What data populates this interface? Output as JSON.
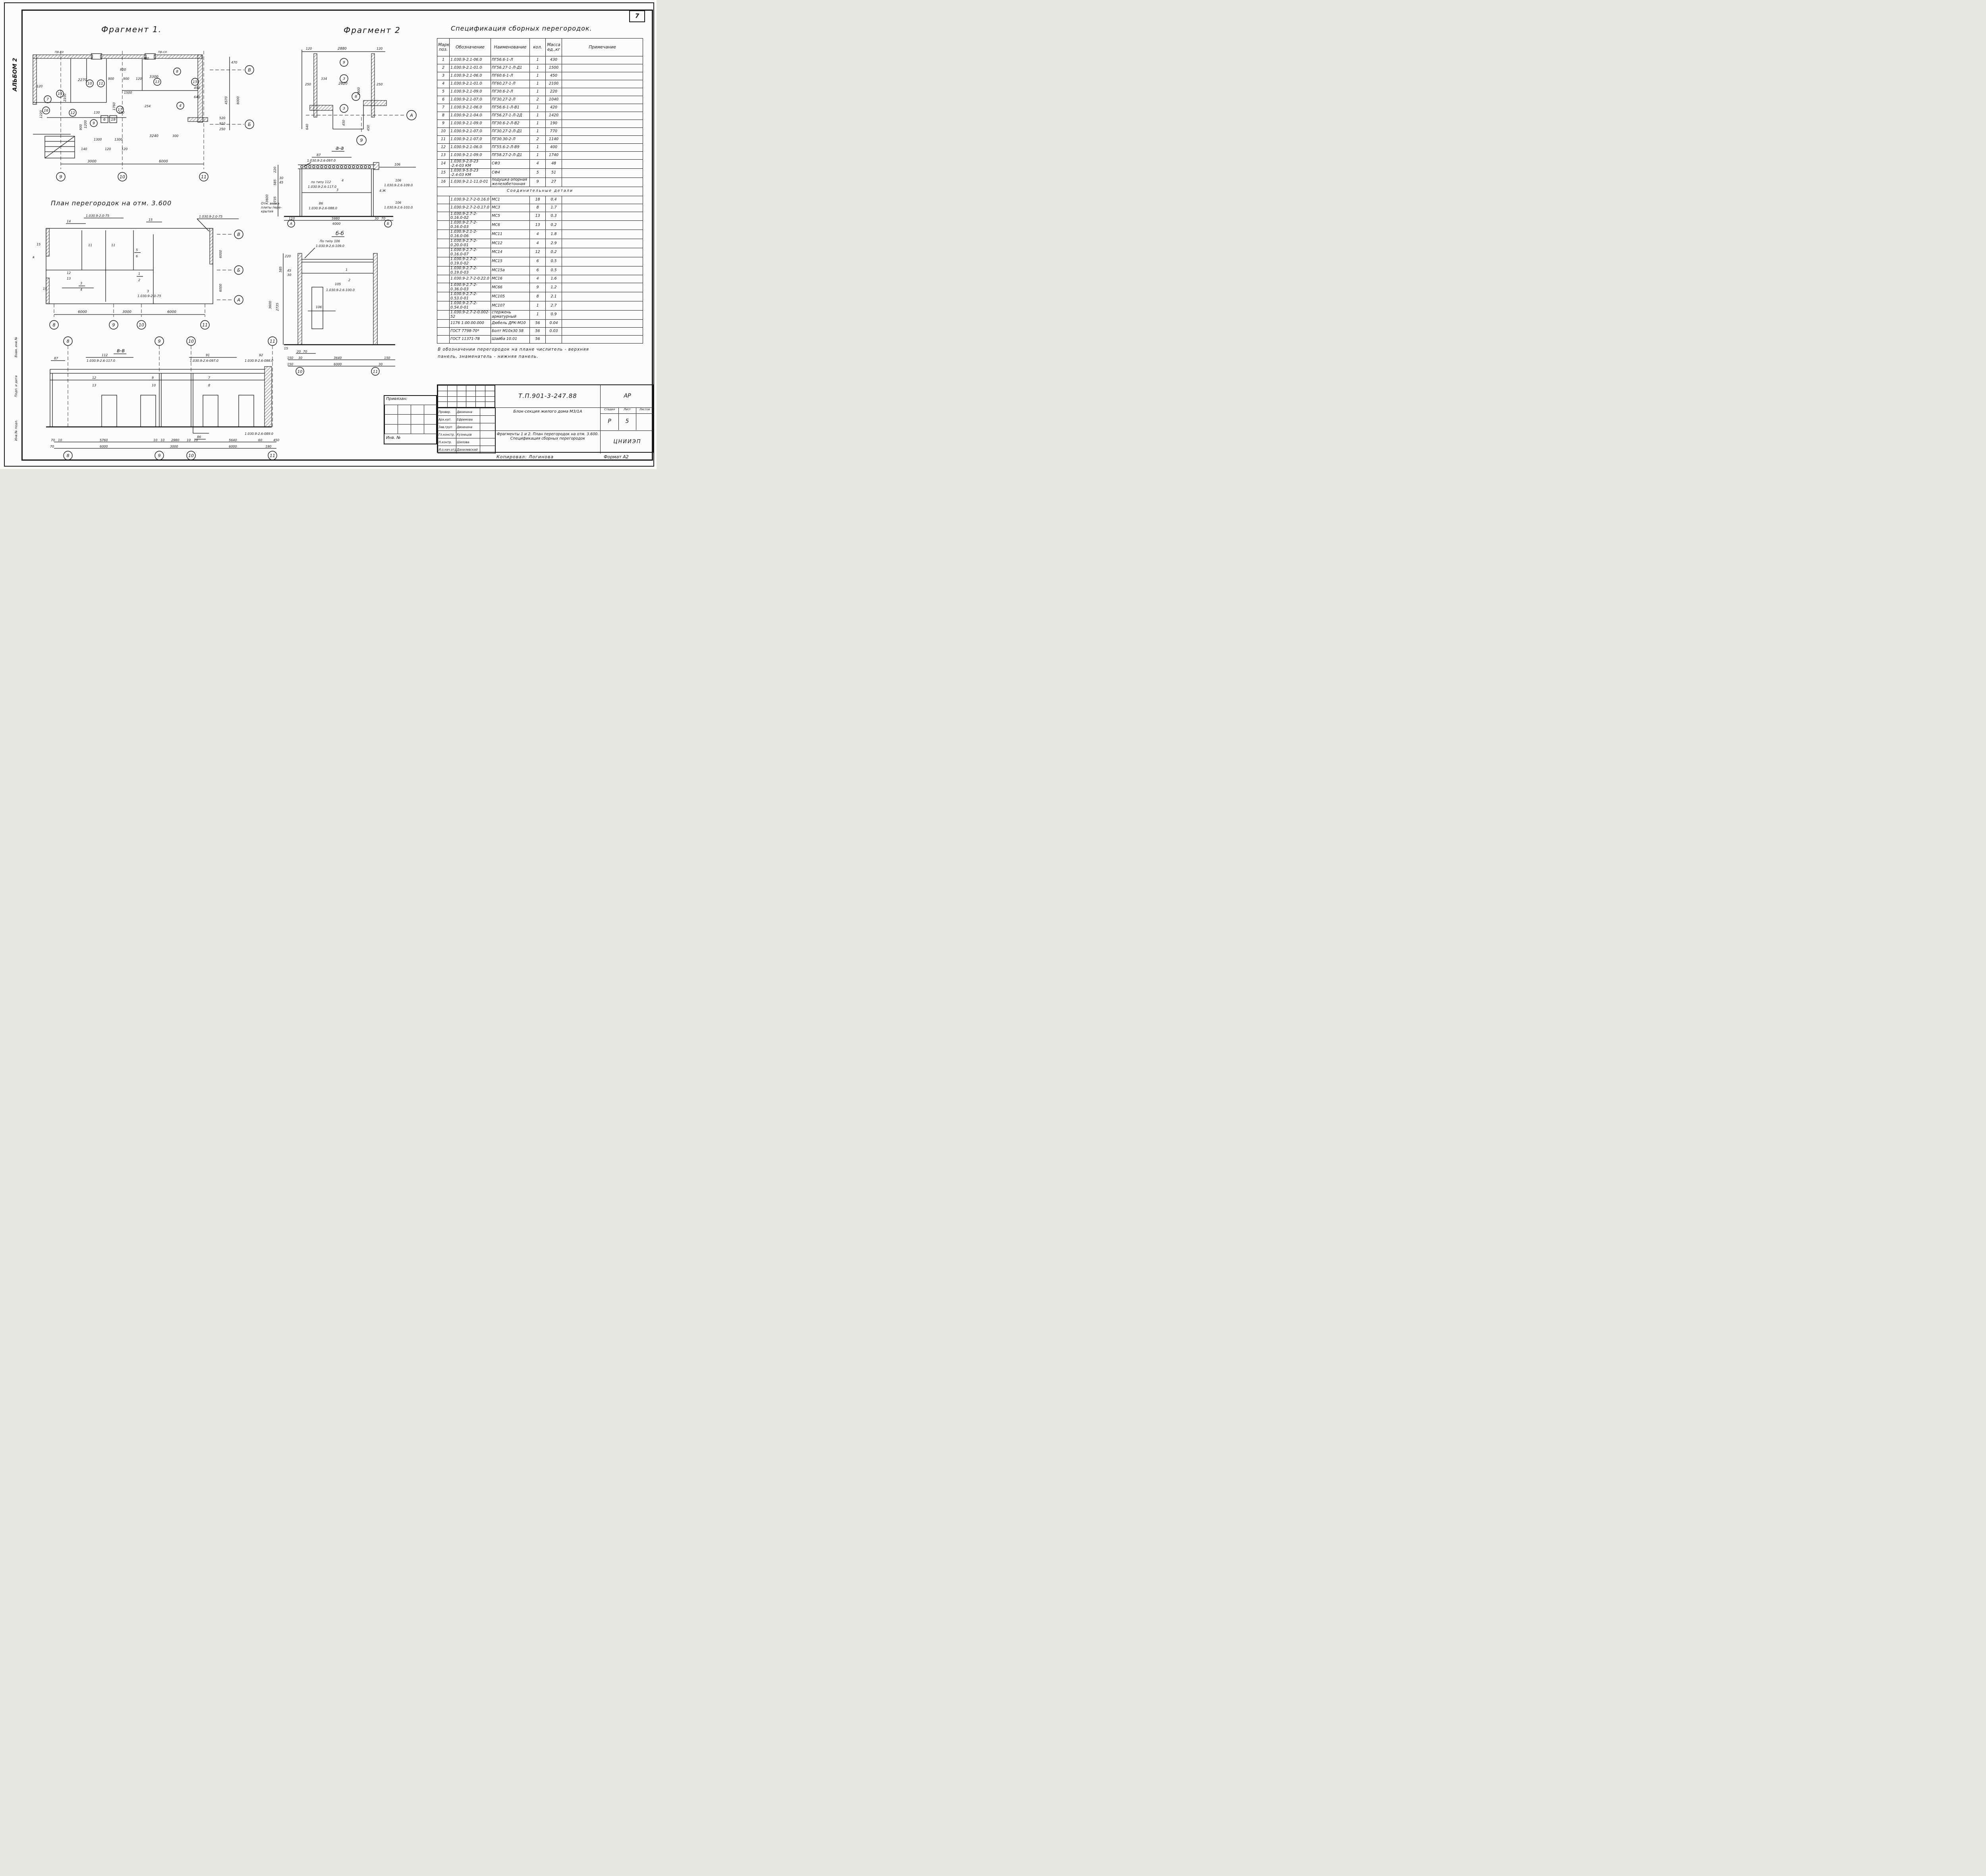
{
  "page": {
    "number": "7",
    "album_label": "АЛЬБОМ 2",
    "margin_stamp_1": "Взам. инв.№",
    "margin_stamp_2": "Подп. и дата",
    "margin_stamp_3": "Инв.№ подл."
  },
  "titles": {
    "fragment1": "Фрагмент 1.",
    "fragment2": "Фрагмент 2",
    "spec": "Спецификация сборных перегородок.",
    "plan": "План перегородок на отм. 3.600",
    "section_aa": "а-а",
    "section_bb": "б-б",
    "section_vv": "в-в",
    "connectors": "Соединительные детали"
  },
  "spec_table": {
    "columns": [
      "Марка поз.",
      "Обозначение",
      "Наименование",
      "кол.",
      "Масса ед.,кг",
      "Примечание"
    ],
    "rows": [
      [
        "1",
        "1.030.9-2.1-06.0",
        "ПГ56.6-1-Л",
        "1",
        "430",
        ""
      ],
      [
        "2",
        "1.030.9-2.1-01.0",
        "ПГ56.27-1-Л-Д1",
        "1",
        "1500",
        ""
      ],
      [
        "3",
        "1.030.9-2.1-06.0",
        "ПГ60.6-1-Л",
        "1",
        "450",
        ""
      ],
      [
        "4",
        "1.030.9-2.1-01.0",
        "ПГ60.27-1-Л",
        "1",
        "2100",
        ""
      ],
      [
        "5",
        "1.030.9-2.1-09.0",
        "ПГ30.6-2-Л",
        "1",
        "220",
        ""
      ],
      [
        "6",
        "1.030.9-2.1-07.0",
        "ПГ30.27-2-Л",
        "2",
        "1040",
        ""
      ],
      [
        "7",
        "1.030.9-2.1-06.0",
        "ПГ56.6-1-Л-В1",
        "1",
        "420",
        ""
      ],
      [
        "8",
        "1.030.9-2.1-04.0",
        "ПГ56.27-1-Л-2Д",
        "1",
        "1420",
        ""
      ],
      [
        "9",
        "1.030.9-2.1-09.0",
        "ПГ30.6-2-Л-В2",
        "1",
        "190",
        ""
      ],
      [
        "10",
        "1.030.9-2.1-07.0",
        "ПГ30.27-2-Л-Д1",
        "1",
        "770",
        ""
      ],
      [
        "11",
        "1.030.9-2.1-07.0",
        "ПГ30.30-2-Л",
        "2",
        "1140",
        ""
      ],
      [
        "12",
        "1.030.9-2.1-06.0",
        "ПГ55.6-2-Л-В9",
        "1",
        "400",
        ""
      ],
      [
        "13",
        "1.030.9-2.1-09.0",
        "ПГ58.27-2-Л-Д1",
        "1",
        "1740",
        ""
      ],
      [
        "14",
        "1.030.9-2.0-23\n-2.4-03 КМ",
        "СФ3",
        "4",
        "48",
        ""
      ],
      [
        "15",
        "1.030.9-5.0-23\n-2.4-03 КМ",
        "СФ4",
        "5",
        "51",
        ""
      ],
      [
        "16",
        "1.030.9-2.1-11.0-01",
        "подушка опорная\nжелезобетонная",
        "9",
        "27",
        ""
      ]
    ],
    "connector_rows": [
      [
        "",
        "1.030.9-2.7-2-0.16.0",
        "МС1",
        "18",
        "0.4",
        ""
      ],
      [
        "",
        "1.030.9-2.7-2-0.17.0",
        "МС3",
        "8",
        "1.7",
        ""
      ],
      [
        "",
        "1.030.9-2.7-2-0.16.0-02",
        "МС5",
        "13",
        "0.3",
        ""
      ],
      [
        "",
        "1.030.9-2.7-2-0.16.0-03",
        "МС6",
        "13",
        "0.2",
        ""
      ],
      [
        "",
        "1.030.9-2.1-2-0.16.0-06",
        "МС11",
        "4",
        "1.8",
        ""
      ],
      [
        "",
        "1.030.9-2.7-2-0.20.0-01",
        "МС12",
        "4",
        "2.9",
        ""
      ],
      [
        "",
        "1.030.9-2.7-2-0.16.0-07",
        "МС14",
        "12",
        "0.2",
        ""
      ],
      [
        "",
        "1.030.9-2.7-2-0.19.0-02",
        "МС15",
        "6",
        "0.5",
        ""
      ],
      [
        "",
        "1.030.9-2.7-2-0.19.0-03",
        "МС15а",
        "6",
        "0.5",
        ""
      ],
      [
        "",
        "1.030.9-2.7-2-0.22.0",
        "МС16",
        "4",
        "1.6",
        ""
      ],
      [
        "",
        "1.030.9-2.7-2-0.36.0-03",
        "МС66",
        "9",
        "1.2",
        ""
      ],
      [
        "",
        "1.030.9-2.7-2-0.53.0-01",
        "МС105",
        "8",
        "2.1",
        ""
      ],
      [
        "",
        "1.030.9-2.7-2-0.54.0-01",
        "МС107",
        "1",
        "2.7",
        ""
      ],
      [
        "",
        "1.030.9-2.7-2-0.002-52",
        "стержень\nарматурный",
        "1",
        "0.9",
        ""
      ],
      [
        "",
        "1176 1.00.00.000",
        "Дюбель ДРК-М10",
        "56",
        "0.04",
        ""
      ],
      [
        "",
        "ГОСТ 7798-70*",
        "Болт М10х30 58",
        "56",
        "0.03",
        ""
      ],
      [
        "",
        "ГОСТ 11371-78",
        "Шайба 10.01",
        "56",
        "",
        ""
      ]
    ]
  },
  "note": {
    "line1": "В обозначении перегородок на плане числитель - верхняя",
    "line2": "панель, знаменатель - нижняя панель."
  },
  "title_block": {
    "doc_number": "Т.П.901-3-247.88",
    "mark": "АР",
    "roles": [
      [
        "Провер.",
        "Двоинина",
        ""
      ],
      [
        "Арх.кат.",
        "Ефремова",
        ""
      ],
      [
        "Зав.груп",
        "Двоинина",
        ""
      ],
      [
        "Гл.констр.",
        "Кузнецов",
        ""
      ],
      [
        "Н.контр.",
        "Шилова",
        ""
      ],
      [
        "И.о.нач.отд",
        "Данилевский",
        ""
      ]
    ],
    "object": "Блок-секция жилого дома М3/1А",
    "sheet_title": "Фрагменты 1 и 2. План перегородок на отм. 3.600. Спецификация сборных перегородок",
    "stage_label": "Стадия",
    "sheet_label": "Лист",
    "sheets_label": "Листов",
    "stage": "Р",
    "sheet": "5",
    "org": "ЦНИИЭП",
    "copied_by": "Копировал: Логинова",
    "format": "Формат А2",
    "privyazan": "Привязан:",
    "inv": "Инв. №"
  },
  "frag1": {
    "top_note_left": "пр.со",
    "top_note_right": "пр.со",
    "dims": {
      "a": "2270",
      "b": "300",
      "c": "900",
      "d": "900",
      "e": "120",
      "f": "3300",
      "g": "800",
      "h": "120",
      "i": "2100",
      "j": "1500",
      "k": "1760",
      "l": "1220",
      "m": "254",
      "n": "130",
      "o": "190",
      "p": "1300",
      "q": "1300",
      "r": "140",
      "s": "120",
      "t": "120",
      "u": "3240",
      "v": "300",
      "w": "3000",
      "x": "6000",
      "y": "470",
      "z": "4570",
      "aa": "6000",
      "ab": "520",
      "ac": "910",
      "ad": "250",
      "ae": "450",
      "af": "640",
      "ah": "1200",
      "ai": "900"
    },
    "circles": {
      "c14": "14",
      "c10": "10",
      "c11": "11",
      "c13": "13",
      "c8": "8",
      "c7": "7",
      "c16": "16",
      "c12": "12",
      "c17": "17",
      "c9": "9",
      "c15": "15",
      "c4": "4",
      "s6": "6",
      "s19": "19"
    },
    "axes": {
      "b9": "9",
      "b10": "10",
      "b11": "11",
      "right_top": "В",
      "right_mid": "Б"
    }
  },
  "frag2": {
    "dims": {
      "d120l": "120",
      "d2880": "2880",
      "d120r": "120",
      "d250l": "250",
      "d2620": "2620",
      "d250r": "250",
      "d334": "334",
      "d1900": "1900",
      "d450a": "450",
      "d450b": "450",
      "d640": "640"
    },
    "circles": {
      "c9": "9",
      "c3a": "3",
      "c8": "8",
      "c3b": "3"
    },
    "axes": {
      "right": "А",
      "bottom": "9"
    }
  },
  "sec_aa": {
    "c87": "87",
    "c87_code": "1.030.9-2.6-097.0",
    "type112": "по типу 112",
    "type112_code": "1.030.9-2.6-117.0",
    "n3": "3",
    "n4": "4",
    "c86": "86",
    "c86_code": "1.030.9-2.6-088.0",
    "r106a": "106",
    "r106b": "106",
    "r106b_code": "1.030.9-2.6-109.0",
    "r4zh": "4.Ж",
    "r106c": "106",
    "r106c_code": "1.030.9-2.6-103.0",
    "d220": "220",
    "d585": "585",
    "d30": "30",
    "d45": "45",
    "d3600": "3600",
    "d2735": "2735",
    "note1": "Отм. верха",
    "note2": "плиты пере-",
    "note3": "крытия",
    "d110": "110",
    "d5980": "5980",
    "d30b": "30",
    "d70": "70",
    "d6000": "6000",
    "axA": "А",
    "axB": "Б"
  },
  "sec_bb": {
    "type106": "По типу 106",
    "type106_code": "1.030.9-2.6-109.0",
    "n1": "1",
    "n2": "2",
    "n105": "105",
    "n105_code": "1.030.9-2.6-100.0",
    "n106": "106",
    "d220": "220",
    "d585": "585",
    "d45": "45",
    "d30": "30",
    "d3600": "3600",
    "d2735": "2735",
    "d15": "15",
    "d20": "20",
    "d70": "70",
    "d150a": "150",
    "d30b": "30",
    "d3640": "3640",
    "d150b": "150",
    "d150c": "150",
    "d6000": "6000",
    "d30c": "30",
    "ax10": "10",
    "ax11": "11"
  },
  "plan36": {
    "callout_left": "1.030.9-2.0-75",
    "callout_right": "1.030.9-2.0-75",
    "callout_mid": "1.030.9-2-0-75",
    "n14": "14",
    "n15a": "15",
    "n15b": "15",
    "n11a": "11",
    "n11b": "11",
    "n5": "5",
    "n6": "6",
    "n12": "12",
    "n13": "13",
    "n3a": "3",
    "n4": "4",
    "n1": "1",
    "n2": "2",
    "n3b": "3",
    "mark_v": "в",
    "d6000r1": "6000",
    "d6000r2": "6000",
    "d6000a": "6000",
    "d3000": "3000",
    "d6000b": "6000",
    "ax8": "8",
    "ax9": "9",
    "ax10": "10",
    "ax11": "11",
    "axA": "А",
    "axB": "Б",
    "axV": "В"
  },
  "sec_vv": {
    "c87": "87",
    "c112": "112",
    "c112_code": "1.030.9-2.6-117.0",
    "c91": "91",
    "c91_code": "1.030.9-2.6-097.0",
    "c92": "92",
    "c92_code": "1.030.9-2.6-098.0",
    "c86": "86",
    "c86_code": "1.030.9-2.6-089.0",
    "n12": "12",
    "n13": "13",
    "n9": "9",
    "n10": "10",
    "n7": "7",
    "n8": "8",
    "d70a": "70",
    "d10a": "10",
    "d5760": "5760",
    "d10b": "10",
    "d10c": "10",
    "d2980": "2980",
    "d10d": "10",
    "d10e": "10",
    "d5640": "5640",
    "d60": "60",
    "d450": "450",
    "d70b": "70",
    "d6000a": "6000",
    "d3000": "3000",
    "d6000b": "6000",
    "d190": "190",
    "ax8": "8",
    "ax9": "9",
    "ax10": "10",
    "ax11": "11"
  }
}
